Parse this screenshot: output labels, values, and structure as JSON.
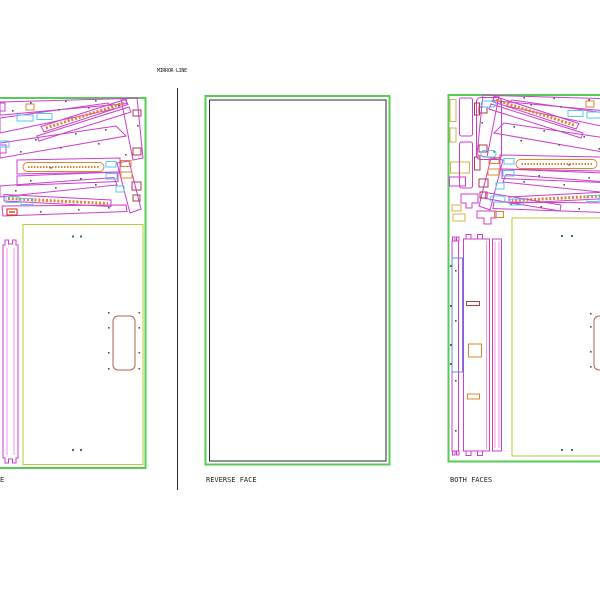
{
  "labels": {
    "mirror_line": "MIRROR LINE",
    "left_sheet_fragment": "E",
    "reverse_face": "REVERSE FACE",
    "both_faces": "BOTH FACES"
  },
  "colors": {
    "sheet_green": "#55cc55",
    "part_magenta": "#cc3fcc",
    "part_pink": "#e87fe8",
    "slot_cyan": "#55c8ee",
    "accent_orange": "#e08430",
    "accent_tan": "#d8b04a",
    "accent_red": "#d22222",
    "accent_maroon": "#b03848",
    "part_olive": "#b9c83a",
    "part_brown": "#b06050",
    "part_blue": "#5590dd",
    "line_black": "#2a2a2a",
    "dot_gray": "#555555",
    "dot_green": "#3a7a3a"
  }
}
